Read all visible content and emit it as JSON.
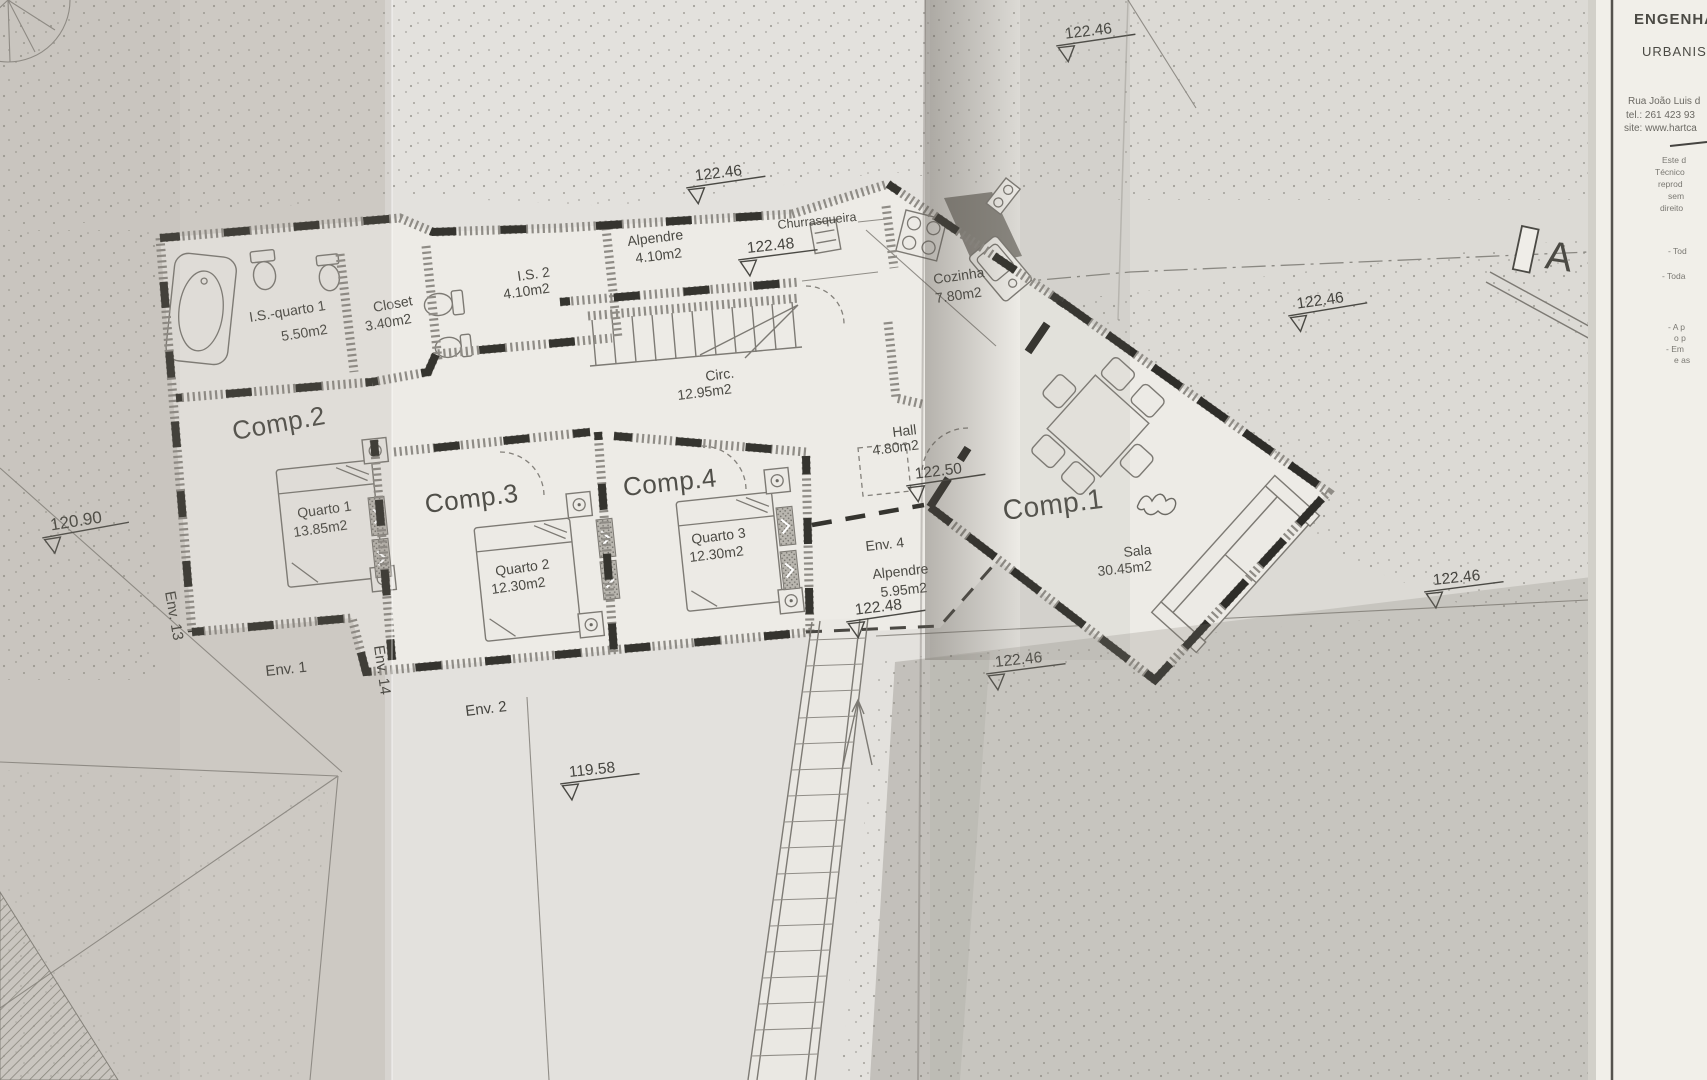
{
  "plan": {
    "rooms": {
      "comp1": {
        "title": "Comp.1",
        "name": "Sala",
        "area": "30.45m2"
      },
      "comp2": {
        "title": "Comp.2",
        "name": "Quarto 1",
        "area": "13.85m2"
      },
      "comp3": {
        "title": "Comp.3",
        "name": "Quarto 2",
        "area": "12.30m2"
      },
      "comp4": {
        "title": "Comp.4",
        "name": "Quarto 3",
        "area": "12.30m2"
      },
      "is_quarto1": {
        "name": "I.S.-quarto 1",
        "area": "5.50m2"
      },
      "closet": {
        "name": "Closet",
        "area": "3.40m2"
      },
      "is2": {
        "name": "I.S. 2",
        "area": "4.10m2"
      },
      "alpendre": {
        "name": "Alpendre",
        "area": "4.10m2"
      },
      "churrasqueira": {
        "name": "Churrasqueira"
      },
      "cozinha": {
        "name": "Cozinha",
        "area": "7.80m2"
      },
      "circ": {
        "name": "Circ.",
        "area": "12.95m2"
      },
      "hall": {
        "name": "Hall",
        "area": "4.80m2"
      },
      "env4": {
        "label": "Env. 4",
        "name": "Alpendre",
        "area": "5.95m2"
      }
    },
    "env_labels": {
      "env1": "Env. 1",
      "env2": "Env. 2",
      "env13": "Env. 13",
      "env14": "Env. 14"
    },
    "elevations": {
      "top": "122.46",
      "alpendre_top": "122.46",
      "alpendre_in": "122.48",
      "site_right_upper": "122.46",
      "hall": "122.50",
      "site_left": "120.90",
      "site_right_lower": "122.46",
      "env4": "122.48",
      "terrace": "122.46",
      "site_bottom": "119.58"
    },
    "section_marker": "A"
  },
  "title_block": {
    "company_line1": "ENGENHA",
    "company_line2": "URBANIS",
    "address": "Rua João Luis d",
    "phone": "tel.: 261 423 93",
    "website": "site: www.hartca",
    "disclaimer": [
      "Este d",
      "Técnico",
      "reprod",
      "sem",
      "direito"
    ],
    "notes": [
      "- Tod",
      "- Toda",
      "- A p",
      "o p",
      "- Em",
      "e as"
    ]
  }
}
